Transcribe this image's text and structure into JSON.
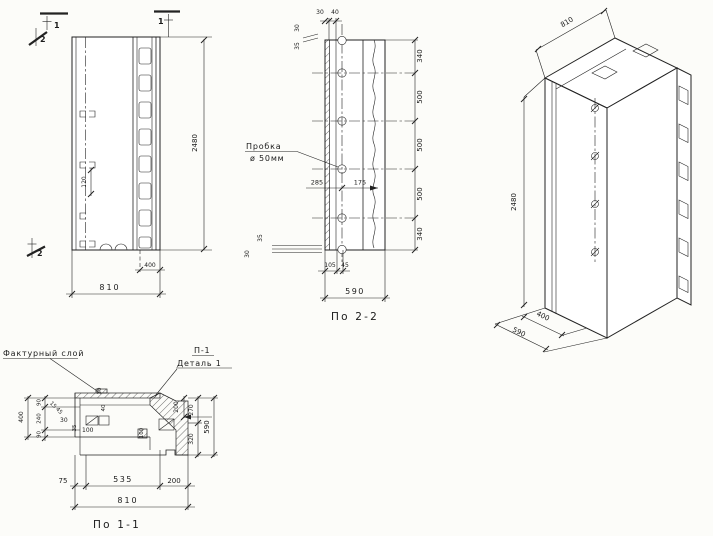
{
  "drawing_type": "concrete panel working drawing",
  "elevation": {
    "marker_top_left": "1",
    "marker_top_mid": "1",
    "marker_sec2_top": "2",
    "marker_sec2_bottom": "2",
    "dim_height": "2480",
    "dim_inner": "120",
    "dim_channel": "400",
    "dim_width": "810"
  },
  "section2": {
    "title": "По 2-2",
    "plug_line1": "Пробка",
    "plug_line2": "ø 50мм",
    "dim_top_a": "30",
    "dim_top_b": "40",
    "dim_topleft_a": "30",
    "dim_topleft_b": "35",
    "dim_mid_a": "285",
    "dim_mid_b": "175",
    "dim_botleft_a": "35",
    "dim_botleft_b": "30",
    "dim_bot_a": "105",
    "dim_bot_b": "45",
    "dim_right": [
      "340",
      "500",
      "500",
      "500",
      "340"
    ],
    "dim_width": "590"
  },
  "iso": {
    "dim_width": "810",
    "dim_height": "2480",
    "dim_depth_inner": "400",
    "dim_depth": "590"
  },
  "section1": {
    "title": "По 1-1",
    "label_facture": "Фактурный слой",
    "label_p1": "П-1",
    "label_detail": "Деталь 1",
    "dim_left_total": "400",
    "dim_left_a": "90",
    "dim_left_b": "240",
    "dim_left_c": "90",
    "dim_d15": "15",
    "dim_d45": "45",
    "dim_30": "30",
    "dim_35": "35",
    "dim_100": "100",
    "dim_v30": "30",
    "dim_v40": "40",
    "dim_v100": "100",
    "dim_v200": "200",
    "dim_right_a": "270",
    "dim_right_b": "320",
    "dim_right_total": "590",
    "dim_bot_a": "75",
    "dim_bot_b": "535",
    "dim_bot_c": "200",
    "dim_bot_total": "810"
  }
}
